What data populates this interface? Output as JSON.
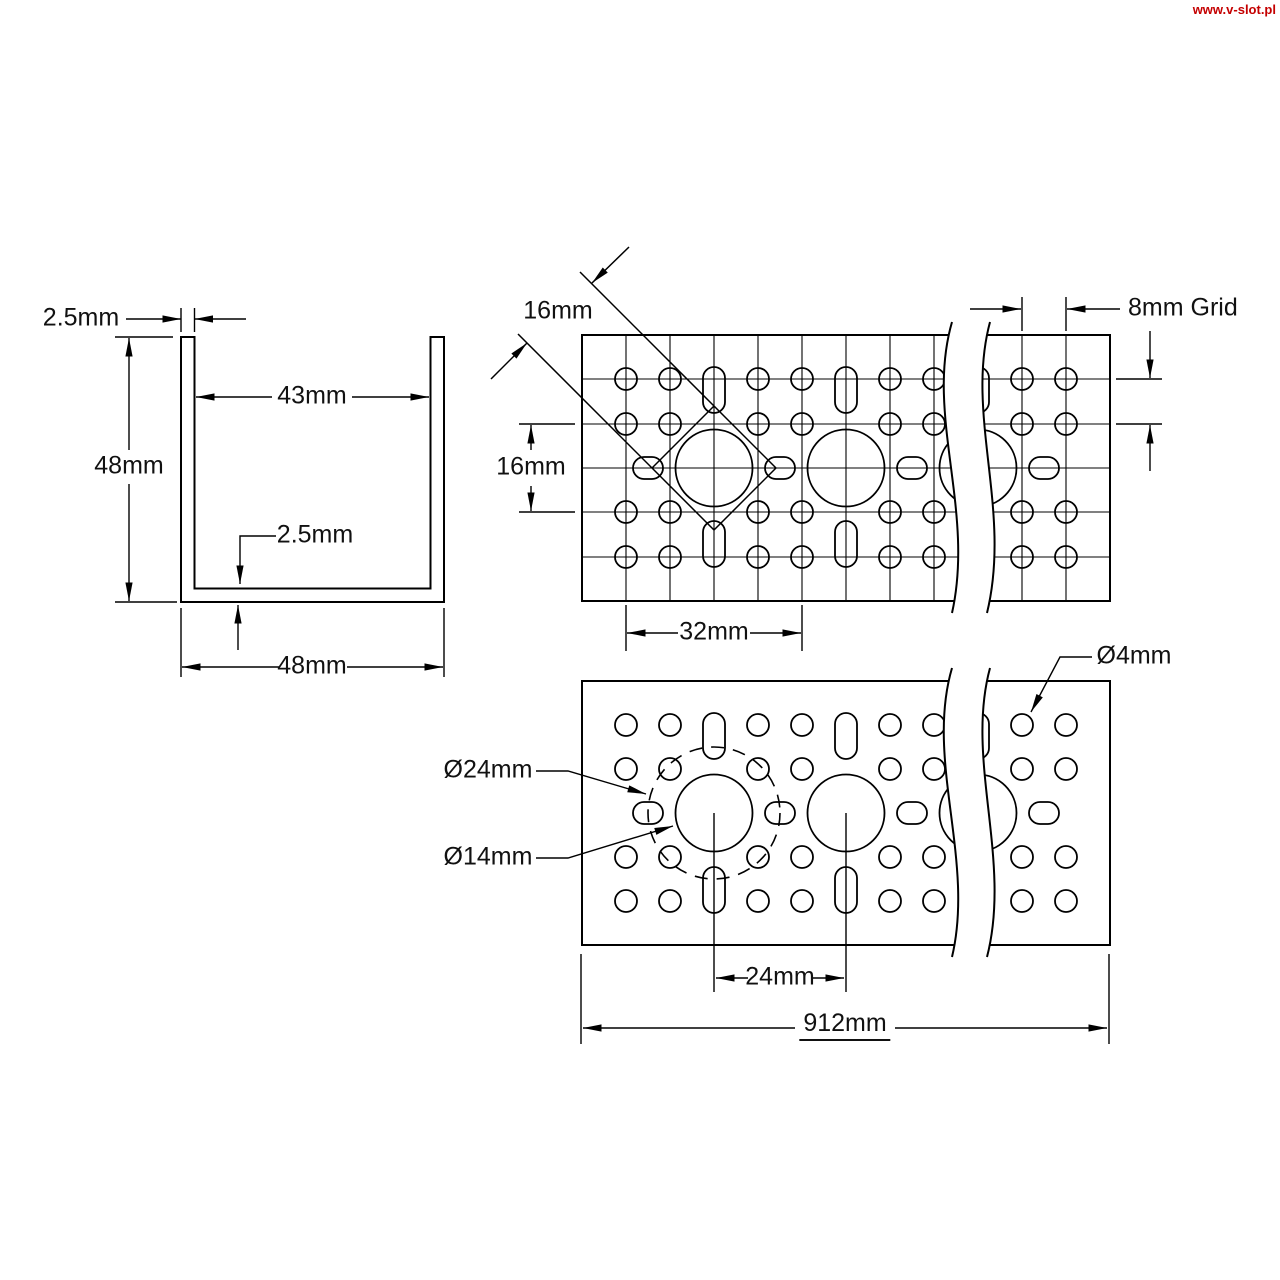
{
  "watermark": "www.v-slot.pl",
  "colors": {
    "line": "#000000",
    "text": "#111111",
    "watermark": "#c40000",
    "background": "#ffffff"
  },
  "views": {
    "cross_section": {
      "title": "channel-cross-section",
      "labels": {
        "wall_thickness_top": "2.5mm",
        "outer_height": "48mm",
        "inner_width": "43mm",
        "bottom_thickness": "2.5mm",
        "outer_width": "48mm"
      }
    },
    "side_view": {
      "title": "channel-side-hole-pattern",
      "labels": {
        "square_pattern_size": "16mm",
        "pattern_height": "16mm",
        "hole_spacing": "32mm",
        "grid": "8mm Grid"
      }
    },
    "face_view": {
      "title": "channel-face-hole-pattern",
      "labels": {
        "small_hole_diameter": "Ø4mm",
        "bolt_circle_diameter": "Ø24mm",
        "large_hole_diameter": "Ø14mm",
        "large_hole_spacing": "24mm",
        "overall_length": "912mm"
      }
    }
  }
}
